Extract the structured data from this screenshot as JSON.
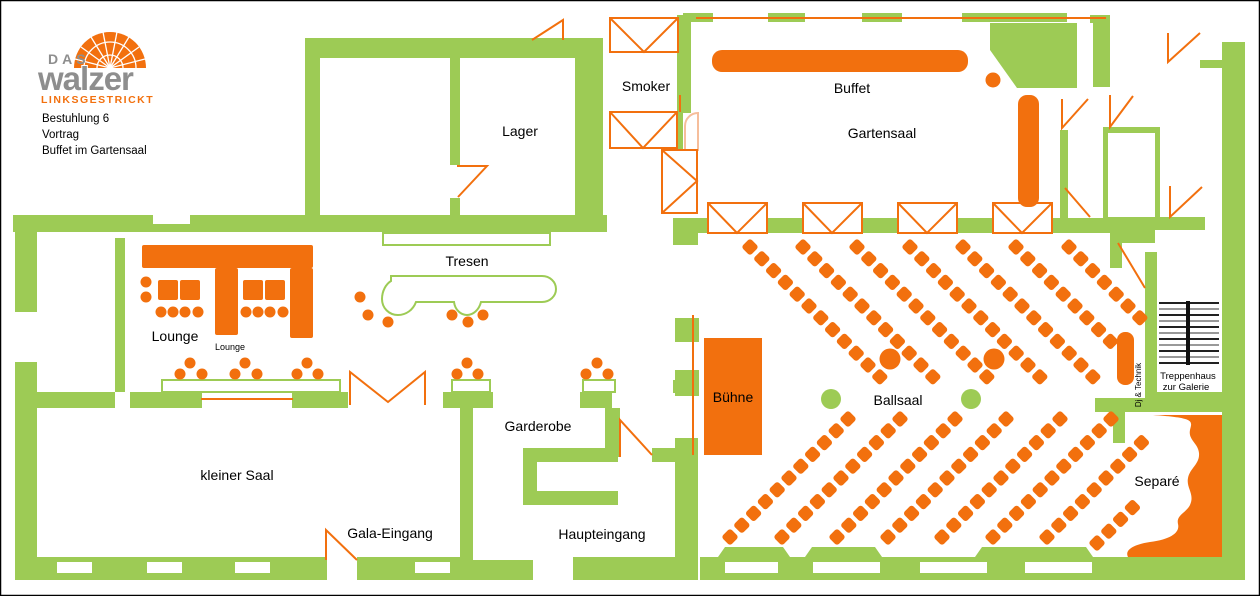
{
  "colors": {
    "green": "#9DCB55",
    "orange": "#F2700E",
    "orange_light": "#F6BE9B",
    "gray": "#8E8E8E"
  },
  "logo": {
    "das": "DAS",
    "name": "walzer",
    "subtitle": "LINKSGESTRICKT"
  },
  "event_info": {
    "line1": "Bestuhlung 6",
    "line2": "Vortrag",
    "line3": "Buffet im Gartensaal"
  },
  "rooms": {
    "smoker": "Smoker",
    "lager": "Lager",
    "buffet": "Buffet",
    "gartensaal": "Gartensaal",
    "tresen": "Tresen",
    "lounge": "Lounge",
    "lounge_small": "Lounge",
    "buehne": "Bühne",
    "ballsaal": "Ballsaal",
    "garderobe": "Garderobe",
    "kleiner_saal": "kleiner Saal",
    "gala_eingang": "Gala-Eingang",
    "haupteingang": "Haupteingang",
    "separe": "Separé",
    "dj_technik": "Dj & Technik",
    "treppenhaus_line1": "Treppenhaus",
    "treppenhaus_line2": "zur Galerie"
  },
  "seating": {
    "chair_size": 12.5,
    "step": 11.8,
    "upper_rows": [
      {
        "x": 750,
        "y": 247,
        "n": 12
      },
      {
        "x": 803,
        "y": 247,
        "n": 12
      },
      {
        "x": 857,
        "y": 247,
        "n": 12
      },
      {
        "x": 910,
        "y": 247,
        "n": 12
      },
      {
        "x": 963,
        "y": 247,
        "n": 12
      },
      {
        "x": 1016,
        "y": 247,
        "n": 9
      },
      {
        "x": 1069,
        "y": 247,
        "n": 7
      }
    ],
    "lower_rows": [
      {
        "x": 730,
        "y": 537,
        "n": 11
      },
      {
        "x": 782,
        "y": 537,
        "n": 11
      },
      {
        "x": 837,
        "y": 537,
        "n": 11
      },
      {
        "x": 888,
        "y": 537,
        "n": 11
      },
      {
        "x": 942,
        "y": 537,
        "n": 11
      },
      {
        "x": 993,
        "y": 537,
        "n": 11
      },
      {
        "x": 1047,
        "y": 537,
        "n": 9
      },
      {
        "x": 1097,
        "y": 543,
        "n": 4
      }
    ],
    "round_tables": [
      {
        "cx": 890,
        "cy": 359
      },
      {
        "cx": 994,
        "cy": 359
      }
    ],
    "columns": [
      {
        "cx": 831,
        "cy": 399
      },
      {
        "cx": 971,
        "cy": 399
      }
    ],
    "buffet_dot": {
      "cx": 993,
      "cy": 80
    },
    "stools": [
      [
        146,
        282
      ],
      [
        146,
        297
      ],
      [
        161,
        312
      ],
      [
        173,
        312
      ],
      [
        185,
        312
      ],
      [
        198,
        312
      ],
      [
        246,
        312
      ],
      [
        258,
        312
      ],
      [
        270,
        312
      ],
      [
        283,
        312
      ],
      [
        360,
        297
      ],
      [
        368,
        315
      ],
      [
        388,
        322
      ],
      [
        452,
        315
      ],
      [
        468,
        322
      ],
      [
        483,
        315
      ],
      [
        190,
        363
      ],
      [
        180,
        374
      ],
      [
        202,
        374
      ],
      [
        245,
        363
      ],
      [
        235,
        374
      ],
      [
        257,
        374
      ],
      [
        307,
        363
      ],
      [
        297,
        374
      ],
      [
        318,
        374
      ],
      [
        467,
        363
      ],
      [
        457,
        374
      ],
      [
        478,
        374
      ],
      [
        597,
        363
      ],
      [
        586,
        374
      ],
      [
        608,
        374
      ]
    ]
  }
}
